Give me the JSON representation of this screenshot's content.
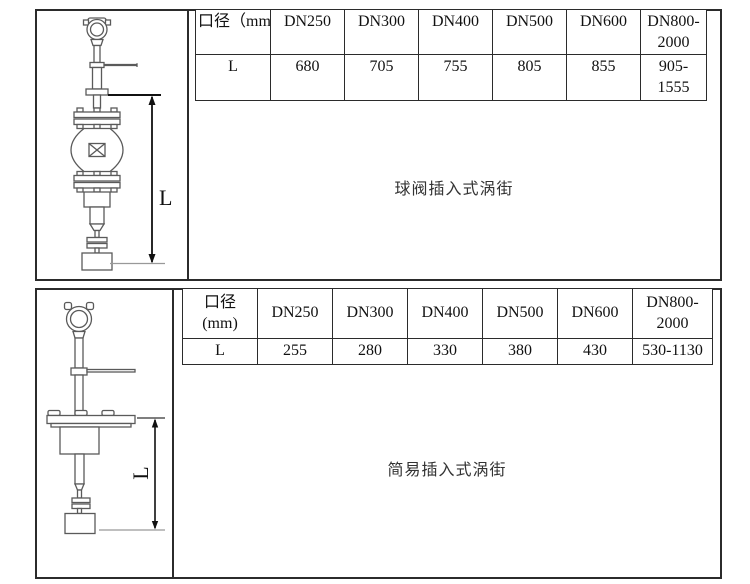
{
  "page": {
    "background": "#ffffff",
    "line_color": "#2b2b2b"
  },
  "sections": [
    {
      "name": "ball-valve-insertion",
      "caption": "球阀插入式涡街",
      "dimension_label": "L",
      "table": {
        "header": [
          "口径（mm）",
          "DN250",
          "DN300",
          "DN400",
          "DN500",
          "DN600",
          "DN800-2000"
        ],
        "rows": [
          [
            "L",
            "680",
            "705",
            "755",
            "805",
            "855",
            "905-1555"
          ]
        ]
      }
    },
    {
      "name": "simple-insertion",
      "caption": "简易插入式涡街",
      "dimension_label": "L",
      "table": {
        "header": [
          "口径\n(mm)",
          "DN250",
          "DN300",
          "DN400",
          "DN500",
          "DN600",
          "DN800-2000"
        ],
        "rows": [
          [
            "L",
            "255",
            "280",
            "330",
            "380",
            "430",
            "530-1130"
          ]
        ]
      }
    }
  ]
}
